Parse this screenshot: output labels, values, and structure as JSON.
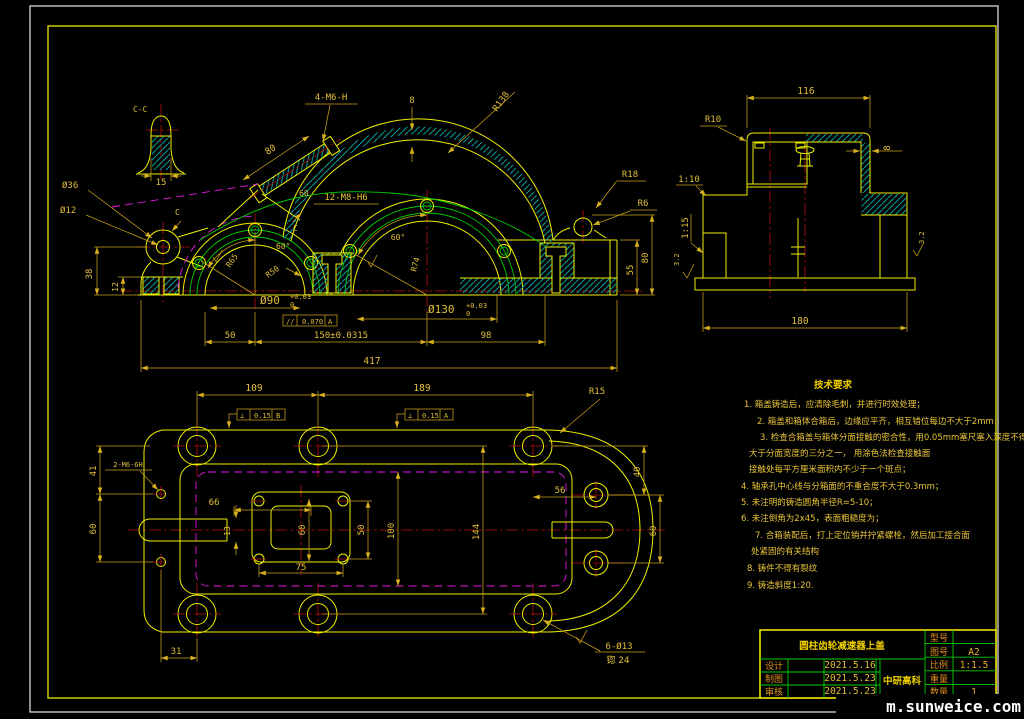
{
  "watermark": "m.sunweice.com",
  "views": {
    "detail": {
      "label": "C-C",
      "d15": "15"
    },
    "front": {
      "label_4m6h": "4-M6-H",
      "d80_cover": "80",
      "d60_cover": "60",
      "label_12m8h6": "12-M8-H6",
      "d8_wall": "8",
      "r138": "R138",
      "r18": "R18",
      "r6": "R6",
      "deg60_left": "60°",
      "deg60_right": "60°",
      "r65": "R65",
      "r50": "R50",
      "r74": "R74",
      "dia36": "Ø36",
      "dia12": "Ø12",
      "d38": "38",
      "d12": "12",
      "dia90": "Ø90",
      "dia90_tol_top": "+0.03",
      "dia90_tol_bot": "0",
      "dia130": "Ø130",
      "dia130_tol_top": "+0.03",
      "dia130_tol_bot": "0",
      "parallel_sym": "//",
      "parallel_tol": "0.070",
      "parallel_ref": "A",
      "d50": "50",
      "d150": "150±0.0315",
      "d98": "98",
      "d417": "417",
      "d80_right": "80",
      "d55": "55",
      "section_c1": "C",
      "section_c2": "C"
    },
    "side": {
      "d116": "116",
      "r10": "R10",
      "d8": "8",
      "slope_upper": "1:10",
      "slope_lower": "1:15",
      "d180": "180",
      "ra_left": "3.2",
      "ra_right": "3.2"
    },
    "plan": {
      "d109": "109",
      "d189": "189",
      "r15": "R15",
      "d40": "40",
      "d56": "56",
      "d60_right": "60",
      "d144": "144",
      "d100": "100",
      "d66": "66",
      "d13": "13",
      "d60_hole": "60",
      "d50_hole": "50",
      "d75": "75",
      "label_2m6": "2-M6-6H",
      "d41": "41",
      "d60_left": "60",
      "d31": "31",
      "label_6d13": "6-Ø13",
      "label_cbore": "锪 24",
      "perp_sym": "⊥",
      "perp_tol_b": "0.15",
      "perp_ref_b": "B",
      "perp_tol_a": "0.15",
      "perp_ref_a": "A"
    }
  },
  "tech": {
    "title": "技术要求",
    "lines": [
      "1. 箱盖铸造后，应清除毛刺，并进行时效处理；",
      "2. 箱盖和箱体合箱后，边缘应平齐，相互错位每边不大于2mm；",
      "3. 检查合箱盖与箱体分面接触的密合性，用0.05mm塞尺塞入深度不得",
      "大于分面宽度的三分之一，  用涂色法检查接触面",
      "接触处每平方厘米面积内不少于一个斑点；",
      "4. 轴承孔中心线与分箱面的不重合度不大于0.3mm；",
      "5. 未注明的铸造圆角半径R=5-10；",
      "6. 未注倒角为2x45，表面粗糙度为；",
      "7. 合箱装配后，打上定位销并拧紧螺栓，然后加工接合面",
      "处紧固的有关结构",
      "8. 铸件不得有裂纹",
      "9. 铸造斜度1:20."
    ]
  },
  "title_block": {
    "part_name": "圆柱齿轮减速器上盖",
    "company": "中研高科",
    "rows": [
      {
        "label": "设计",
        "date": "2021.5.16"
      },
      {
        "label": "制图",
        "date": "2021.5.23"
      },
      {
        "label": "审核",
        "date": "2021.5.23"
      }
    ],
    "fields": [
      {
        "label": "型号",
        "value": ""
      },
      {
        "label": "图号",
        "value": "A2"
      },
      {
        "label": "比例",
        "value": "1:1.5"
      },
      {
        "label": "重量",
        "value": ""
      },
      {
        "label": "数量",
        "value": "1"
      }
    ]
  }
}
